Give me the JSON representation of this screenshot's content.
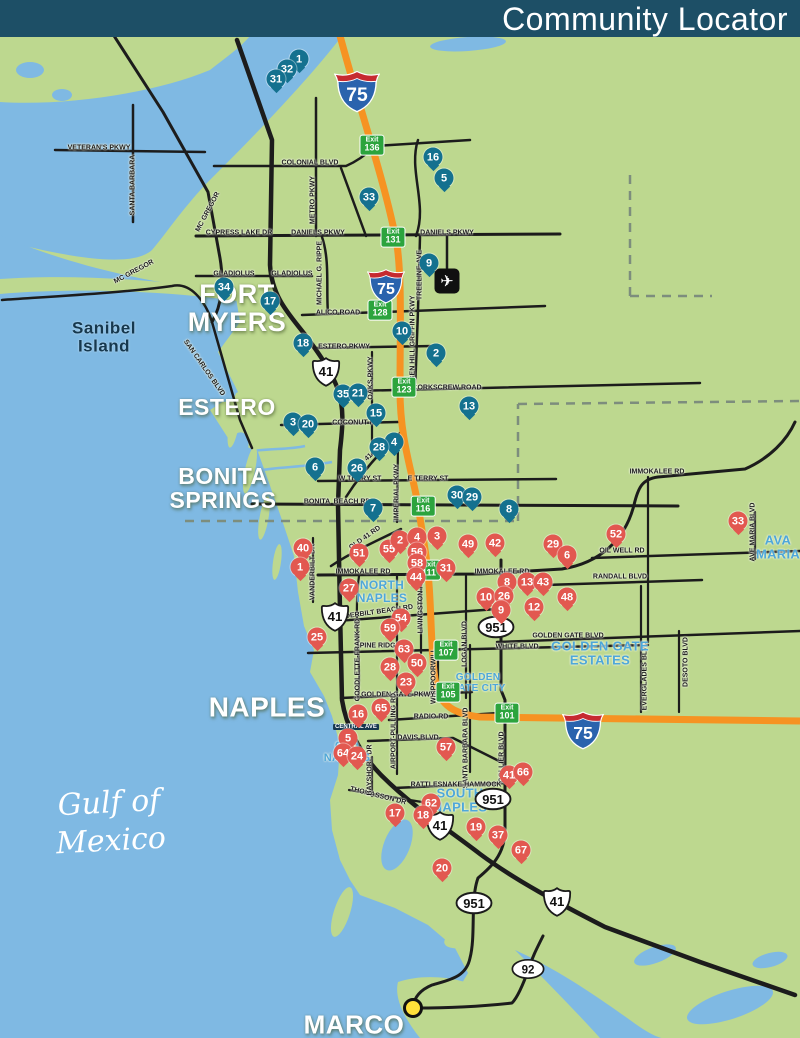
{
  "header": {
    "title": "Community Locator",
    "bg": "#1d4f66"
  },
  "colors": {
    "land": "#bdd88f",
    "water": "#7fb9e3",
    "road": "#1c1c1c",
    "interstate": "#f69322",
    "exit_green": "#2ca43d",
    "pin_blue": "#14718f",
    "pin_red": "#e25850",
    "area_blue": "#4ea7d9",
    "marco_dot": "#ffe03a"
  },
  "map": {
    "cities": [
      {
        "lines": [
          "FORT",
          "MYERS"
        ],
        "x": 237,
        "y": 308,
        "size": 27,
        "dark": false
      },
      {
        "lines": [
          "ESTERO"
        ],
        "x": 227,
        "y": 408,
        "size": 23,
        "dark": false
      },
      {
        "lines": [
          "BONITA",
          "SPRINGS"
        ],
        "x": 223,
        "y": 489,
        "size": 23,
        "dark": false
      },
      {
        "lines": [
          "NAPLES"
        ],
        "x": 267,
        "y": 707,
        "size": 28,
        "dark": false
      },
      {
        "lines": [
          "MARCO"
        ],
        "x": 354,
        "y": 1025,
        "size": 26,
        "dark": false
      },
      {
        "lines": [
          "Sanibel",
          "Island"
        ],
        "x": 104,
        "y": 337,
        "size": 17,
        "dark": true
      }
    ],
    "water_labels": [
      {
        "lines": [
          "Gulf of",
          "Mexico"
        ],
        "x": 110,
        "y": 822,
        "size": 30
      }
    ],
    "areas": [
      {
        "lines": [
          "NORTH",
          "NAPLES"
        ],
        "x": 382,
        "y": 592,
        "size": 12
      },
      {
        "lines": [
          "OLD",
          "NAPLES"
        ],
        "x": 347,
        "y": 752,
        "size": 11
      },
      {
        "lines": [
          "GOLDEN",
          "GATE CITY"
        ],
        "x": 478,
        "y": 683,
        "size": 10
      },
      {
        "lines": [
          "GOLDEN GATE",
          "ESTATES"
        ],
        "x": 600,
        "y": 654,
        "size": 13
      },
      {
        "lines": [
          "SOUTH",
          "NAPLES"
        ],
        "x": 460,
        "y": 801,
        "size": 13
      },
      {
        "lines": [
          "AVA",
          "MARIA"
        ],
        "x": 778,
        "y": 548,
        "size": 13
      }
    ],
    "road_labels": [
      {
        "t": "VETERAN'S PKWY",
        "x": 99,
        "y": 148
      },
      {
        "t": "SANTA BARBARA",
        "x": 133,
        "y": 185,
        "r": -90
      },
      {
        "t": "MC GREGOR",
        "x": 208,
        "y": 212,
        "r": -62
      },
      {
        "t": "CYPRESS LAKE DR",
        "x": 239,
        "y": 233
      },
      {
        "t": "MC GREGOR",
        "x": 134,
        "y": 272,
        "r": -28
      },
      {
        "t": "GLADIOLUS",
        "x": 234,
        "y": 274
      },
      {
        "t": "GLADIOLUS",
        "x": 292,
        "y": 274
      },
      {
        "t": "METRO PKWY",
        "x": 313,
        "y": 200,
        "r": -90
      },
      {
        "t": "COLONIAL BLVD",
        "x": 310,
        "y": 163
      },
      {
        "t": "DANIELS PKWY",
        "x": 318,
        "y": 233
      },
      {
        "t": "DANIELS PKWY",
        "x": 447,
        "y": 233
      },
      {
        "t": "MICHAEL G. RIPPE",
        "x": 320,
        "y": 273,
        "r": -90
      },
      {
        "t": "TREELINE AVE",
        "x": 420,
        "y": 275,
        "r": -90
      },
      {
        "t": "BEN HILL GRIFFIN PKWY",
        "x": 413,
        "y": 338,
        "r": -90
      },
      {
        "t": "ALICO ROAD",
        "x": 338,
        "y": 313
      },
      {
        "t": "ESTERO PKWY",
        "x": 344,
        "y": 347
      },
      {
        "t": "SAN CARLOS BLVD",
        "x": 204,
        "y": 368,
        "r": 55
      },
      {
        "t": "OAKS PKWY",
        "x": 371,
        "y": 378,
        "r": -90
      },
      {
        "t": "CORKSCREW ROAD",
        "x": 447,
        "y": 388
      },
      {
        "t": "COCONUT RD",
        "x": 356,
        "y": 423
      },
      {
        "t": "OLD 41 RD",
        "x": 367,
        "y": 459,
        "r": -42
      },
      {
        "t": "W TERRY ST",
        "x": 360,
        "y": 479
      },
      {
        "t": "E TERRY ST",
        "x": 428,
        "y": 479
      },
      {
        "t": "IMPERIAL PKWY",
        "x": 397,
        "y": 492,
        "r": -90
      },
      {
        "t": "BONITA",
        "x": 317,
        "y": 502
      },
      {
        "t": "BEACH RD",
        "x": 352,
        "y": 502
      },
      {
        "t": "OLD 41 RD",
        "x": 365,
        "y": 538,
        "r": -35
      },
      {
        "t": "VANDERBILT DR",
        "x": 313,
        "y": 572,
        "r": -90
      },
      {
        "t": "IMMOKALEE RD",
        "x": 363,
        "y": 572
      },
      {
        "t": "IMMOKALEE RD",
        "x": 502,
        "y": 572
      },
      {
        "t": "IMMOKALEE RD",
        "x": 657,
        "y": 472
      },
      {
        "t": "OIL WELL RD",
        "x": 622,
        "y": 551
      },
      {
        "t": "RANDALL BLVD",
        "x": 620,
        "y": 577
      },
      {
        "t": "AVE MARIA BLVD",
        "x": 753,
        "y": 532,
        "r": -90
      },
      {
        "t": "VANDERBILT BEACH RD",
        "x": 372,
        "y": 613,
        "r": -8
      },
      {
        "t": "LIVINGSTON RD",
        "x": 421,
        "y": 606,
        "r": -90
      },
      {
        "t": "GOLDEN GATE BLVD",
        "x": 568,
        "y": 636
      },
      {
        "t": "WHITE BLVD",
        "x": 517,
        "y": 647
      },
      {
        "t": "LOGAN BLVD",
        "x": 465,
        "y": 644,
        "r": -90
      },
      {
        "t": "EVERGLADES BLVD",
        "x": 645,
        "y": 676,
        "r": -90
      },
      {
        "t": "DESOTO BLVD",
        "x": 686,
        "y": 662,
        "r": -90
      },
      {
        "t": "GOODLETTE-FRANK RD",
        "x": 358,
        "y": 660,
        "r": -90
      },
      {
        "t": "PINE RIDGE RD",
        "x": 386,
        "y": 646
      },
      {
        "t": "WHIPPOORWILL",
        "x": 434,
        "y": 676,
        "r": -90
      },
      {
        "t": "GOLDEN GATE PKWY",
        "x": 398,
        "y": 695
      },
      {
        "t": "AIRPORT-PULLING RD",
        "x": 394,
        "y": 731,
        "r": -90
      },
      {
        "t": "RADIO RD",
        "x": 431,
        "y": 717
      },
      {
        "t": "SANTA BARBARA BLVD",
        "x": 466,
        "y": 748,
        "r": -90
      },
      {
        "t": "COLLIER BLVD",
        "x": 502,
        "y": 757,
        "r": -90
      },
      {
        "t": "DAVIS BLVD",
        "x": 418,
        "y": 738
      },
      {
        "t": "RATTLESNAKE HAMMOCK",
        "x": 456,
        "y": 785
      },
      {
        "t": "THOMASSON DR",
        "x": 378,
        "y": 796,
        "r": 14
      },
      {
        "t": "BAYSHORE DR",
        "x": 370,
        "y": 770,
        "r": -90
      },
      {
        "t": "CENTRAL AVE",
        "x": 356,
        "y": 727,
        "boxed": true
      }
    ],
    "exits": [
      {
        "w": "Exit",
        "n": "136",
        "x": 372,
        "y": 145
      },
      {
        "w": "Exit",
        "n": "131",
        "x": 393,
        "y": 237
      },
      {
        "w": "Exit",
        "n": "128",
        "x": 380,
        "y": 310
      },
      {
        "w": "Exit",
        "n": "123",
        "x": 404,
        "y": 387
      },
      {
        "w": "Exit",
        "n": "116",
        "x": 423,
        "y": 506
      },
      {
        "w": "Exit",
        "n": "111",
        "x": 429,
        "y": 570
      },
      {
        "w": "Exit",
        "n": "107",
        "x": 446,
        "y": 650
      },
      {
        "w": "Exit",
        "n": "105",
        "x": 448,
        "y": 692
      },
      {
        "w": "Exit",
        "n": "101",
        "x": 507,
        "y": 713
      }
    ],
    "shields": [
      {
        "type": "i75",
        "label": "75",
        "x": 357,
        "y": 90,
        "s": 46
      },
      {
        "type": "i75",
        "label": "75",
        "x": 386,
        "y": 285,
        "s": 38
      },
      {
        "type": "i75",
        "label": "75",
        "x": 583,
        "y": 729,
        "s": 42
      },
      {
        "type": "us41",
        "label": "41",
        "x": 326,
        "y": 372,
        "s": 30
      },
      {
        "type": "us41",
        "label": "41",
        "x": 335,
        "y": 617,
        "s": 30
      },
      {
        "type": "us41",
        "label": "41",
        "x": 440,
        "y": 826,
        "s": 30
      },
      {
        "type": "us41",
        "label": "41",
        "x": 557,
        "y": 902,
        "s": 30
      },
      {
        "type": "oval",
        "label": "951",
        "x": 496,
        "y": 627,
        "s": 38
      },
      {
        "type": "oval",
        "label": "951",
        "x": 493,
        "y": 799,
        "s": 38
      },
      {
        "type": "oval",
        "label": "951",
        "x": 474,
        "y": 903,
        "s": 38
      },
      {
        "type": "oval",
        "label": "92",
        "x": 528,
        "y": 969,
        "s": 34
      }
    ],
    "poi": [
      {
        "type": "airport-icon",
        "glyph": "✈",
        "x": 447,
        "y": 281
      },
      {
        "type": "destination-dot",
        "glyph": "",
        "x": 413,
        "y": 1008
      }
    ],
    "markers": [
      {
        "n": "1",
        "c": "b",
        "x": 299,
        "y": 59
      },
      {
        "n": "32",
        "c": "b",
        "x": 287,
        "y": 69
      },
      {
        "n": "31",
        "c": "b",
        "x": 276,
        "y": 79
      },
      {
        "n": "16",
        "c": "b",
        "x": 433,
        "y": 157
      },
      {
        "n": "5",
        "c": "b",
        "x": 444,
        "y": 178
      },
      {
        "n": "33",
        "c": "b",
        "x": 369,
        "y": 197
      },
      {
        "n": "9",
        "c": "b",
        "x": 429,
        "y": 263
      },
      {
        "n": "34",
        "c": "b",
        "x": 224,
        "y": 287
      },
      {
        "n": "17",
        "c": "b",
        "x": 270,
        "y": 301
      },
      {
        "n": "10",
        "c": "b",
        "x": 402,
        "y": 331
      },
      {
        "n": "18",
        "c": "b",
        "x": 303,
        "y": 343
      },
      {
        "n": "2",
        "c": "b",
        "x": 436,
        "y": 353
      },
      {
        "n": "35",
        "c": "b",
        "x": 343,
        "y": 394
      },
      {
        "n": "21",
        "c": "b",
        "x": 358,
        "y": 393
      },
      {
        "n": "15",
        "c": "b",
        "x": 376,
        "y": 413
      },
      {
        "n": "13",
        "c": "b",
        "x": 469,
        "y": 406
      },
      {
        "n": "3",
        "c": "b",
        "x": 293,
        "y": 422
      },
      {
        "n": "20",
        "c": "b",
        "x": 308,
        "y": 424
      },
      {
        "n": "4",
        "c": "b",
        "x": 394,
        "y": 442
      },
      {
        "n": "28",
        "c": "b",
        "x": 379,
        "y": 447
      },
      {
        "n": "26",
        "c": "b",
        "x": 357,
        "y": 468
      },
      {
        "n": "6",
        "c": "b",
        "x": 315,
        "y": 467
      },
      {
        "n": "7",
        "c": "b",
        "x": 373,
        "y": 508
      },
      {
        "n": "30",
        "c": "b",
        "x": 457,
        "y": 495
      },
      {
        "n": "29",
        "c": "b",
        "x": 472,
        "y": 497
      },
      {
        "n": "8",
        "c": "b",
        "x": 509,
        "y": 509
      },
      {
        "n": "40",
        "c": "r",
        "x": 303,
        "y": 548
      },
      {
        "n": "1",
        "c": "r",
        "x": 300,
        "y": 567
      },
      {
        "n": "51",
        "c": "r",
        "x": 359,
        "y": 553
      },
      {
        "n": "55",
        "c": "r",
        "x": 389,
        "y": 549
      },
      {
        "n": "2",
        "c": "r",
        "x": 400,
        "y": 540
      },
      {
        "n": "4",
        "c": "r",
        "x": 417,
        "y": 537
      },
      {
        "n": "3",
        "c": "r",
        "x": 437,
        "y": 536
      },
      {
        "n": "56",
        "c": "r",
        "x": 417,
        "y": 552
      },
      {
        "n": "58",
        "c": "r",
        "x": 417,
        "y": 563
      },
      {
        "n": "49",
        "c": "r",
        "x": 468,
        "y": 544
      },
      {
        "n": "42",
        "c": "r",
        "x": 495,
        "y": 543
      },
      {
        "n": "29",
        "c": "r",
        "x": 553,
        "y": 544
      },
      {
        "n": "6",
        "c": "r",
        "x": 567,
        "y": 555
      },
      {
        "n": "52",
        "c": "r",
        "x": 616,
        "y": 534
      },
      {
        "n": "33",
        "c": "r",
        "x": 738,
        "y": 521
      },
      {
        "n": "27",
        "c": "r",
        "x": 349,
        "y": 588
      },
      {
        "n": "44",
        "c": "r",
        "x": 416,
        "y": 577
      },
      {
        "n": "31",
        "c": "r",
        "x": 446,
        "y": 568
      },
      {
        "n": "8",
        "c": "r",
        "x": 507,
        "y": 582
      },
      {
        "n": "13",
        "c": "r",
        "x": 527,
        "y": 582
      },
      {
        "n": "43",
        "c": "r",
        "x": 543,
        "y": 582
      },
      {
        "n": "10",
        "c": "r",
        "x": 486,
        "y": 597
      },
      {
        "n": "26",
        "c": "r",
        "x": 504,
        "y": 596
      },
      {
        "n": "9",
        "c": "r",
        "x": 501,
        "y": 610
      },
      {
        "n": "12",
        "c": "r",
        "x": 534,
        "y": 607
      },
      {
        "n": "48",
        "c": "r",
        "x": 567,
        "y": 597
      },
      {
        "n": "25",
        "c": "r",
        "x": 317,
        "y": 637
      },
      {
        "n": "54",
        "c": "r",
        "x": 401,
        "y": 618
      },
      {
        "n": "59",
        "c": "r",
        "x": 390,
        "y": 628
      },
      {
        "n": "63",
        "c": "r",
        "x": 404,
        "y": 649
      },
      {
        "n": "50",
        "c": "r",
        "x": 417,
        "y": 663
      },
      {
        "n": "28",
        "c": "r",
        "x": 390,
        "y": 667
      },
      {
        "n": "23",
        "c": "r",
        "x": 406,
        "y": 682
      },
      {
        "n": "65",
        "c": "r",
        "x": 381,
        "y": 708
      },
      {
        "n": "16",
        "c": "r",
        "x": 358,
        "y": 714
      },
      {
        "n": "5",
        "c": "r",
        "x": 348,
        "y": 738
      },
      {
        "n": "64",
        "c": "r",
        "x": 343,
        "y": 753
      },
      {
        "n": "24",
        "c": "r",
        "x": 357,
        "y": 756
      },
      {
        "n": "57",
        "c": "r",
        "x": 446,
        "y": 747
      },
      {
        "n": "41",
        "c": "r",
        "x": 509,
        "y": 775
      },
      {
        "n": "66",
        "c": "r",
        "x": 523,
        "y": 772
      },
      {
        "n": "62",
        "c": "r",
        "x": 431,
        "y": 803
      },
      {
        "n": "17",
        "c": "r",
        "x": 395,
        "y": 813
      },
      {
        "n": "18",
        "c": "r",
        "x": 423,
        "y": 815
      },
      {
        "n": "19",
        "c": "r",
        "x": 476,
        "y": 827
      },
      {
        "n": "37",
        "c": "r",
        "x": 498,
        "y": 835
      },
      {
        "n": "67",
        "c": "r",
        "x": 521,
        "y": 850
      },
      {
        "n": "20",
        "c": "r",
        "x": 442,
        "y": 868
      }
    ]
  }
}
